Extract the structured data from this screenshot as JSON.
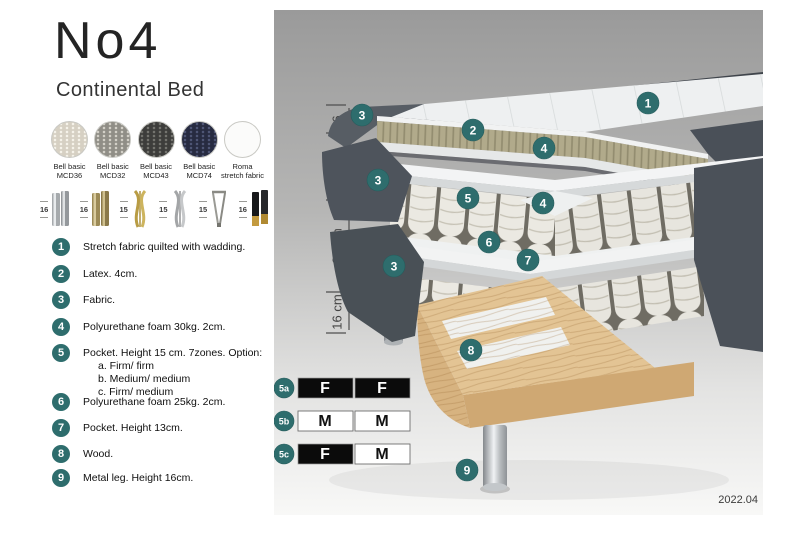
{
  "header": {
    "title": "No4",
    "subtitle": "Continental Bed"
  },
  "swatches": [
    {
      "label_top": "Bell basic",
      "label_bottom": "MCD36"
    },
    {
      "label_top": "Bell basic",
      "label_bottom": "MCD32"
    },
    {
      "label_top": "Bell basic",
      "label_bottom": "MCD43"
    },
    {
      "label_top": "Bell basic",
      "label_bottom": "MCD74"
    },
    {
      "label_top": "Roma",
      "label_bottom": "stretch fabric"
    }
  ],
  "legs": [
    {
      "height": "16",
      "style": "chrome-cylinder"
    },
    {
      "height": "16",
      "style": "brass-cylinder"
    },
    {
      "height": "15",
      "style": "gold-twist"
    },
    {
      "height": "15",
      "style": "silver-twist"
    },
    {
      "height": "15",
      "style": "hairpin"
    },
    {
      "height": "16",
      "style": "black-gold-cylinder"
    }
  ],
  "parts": [
    {
      "num": "1",
      "text": "Stretch fabric quilted with wadding."
    },
    {
      "num": "2",
      "text": "Latex. 4cm."
    },
    {
      "num": "3",
      "text": "Fabric."
    },
    {
      "num": "4",
      "text": "Polyurethane foam 30kg. 2cm."
    },
    {
      "num": "5",
      "text": "Pocket. Height 15 cm. 7zones. Option:",
      "options": [
        "a. Firm/ firm",
        "b. Medium/ medium",
        "c. Firm/ medium"
      ]
    },
    {
      "num": "6",
      "text": "Polyurethane foam 25kg. 2cm."
    },
    {
      "num": "7",
      "text": "Pocket. Height 13cm."
    },
    {
      "num": "8",
      "text": "Wood."
    },
    {
      "num": "9",
      "text": "Metal leg. Height 16cm."
    }
  ],
  "diagram": {
    "dimensions": [
      {
        "label": "6"
      },
      {
        "label": "19 cm"
      },
      {
        "label": "27 cm"
      },
      {
        "label": "16 cm"
      }
    ],
    "callouts": [
      {
        "label": "1"
      },
      {
        "label": "2"
      },
      {
        "label": "3"
      },
      {
        "label": "4"
      },
      {
        "label": "3"
      },
      {
        "label": "5"
      },
      {
        "label": "4"
      },
      {
        "label": "6"
      },
      {
        "label": "7"
      },
      {
        "label": "3"
      },
      {
        "label": "8"
      },
      {
        "label": "9"
      }
    ],
    "firmness": [
      {
        "id": "5a",
        "cells": [
          {
            "letter": "F",
            "filled": true
          },
          {
            "letter": "F",
            "filled": true
          }
        ]
      },
      {
        "id": "5b",
        "cells": [
          {
            "letter": "M",
            "filled": false
          },
          {
            "letter": "M",
            "filled": false
          }
        ]
      },
      {
        "id": "5c",
        "cells": [
          {
            "letter": "F",
            "filled": true
          },
          {
            "letter": "M",
            "filled": false
          }
        ]
      }
    ],
    "version": "2022.04"
  },
  "colors": {
    "accent": "#2E6D6D",
    "latex": "#B1AA8B",
    "wood": "#E3C494",
    "fabric_dark": "#4C525A"
  }
}
